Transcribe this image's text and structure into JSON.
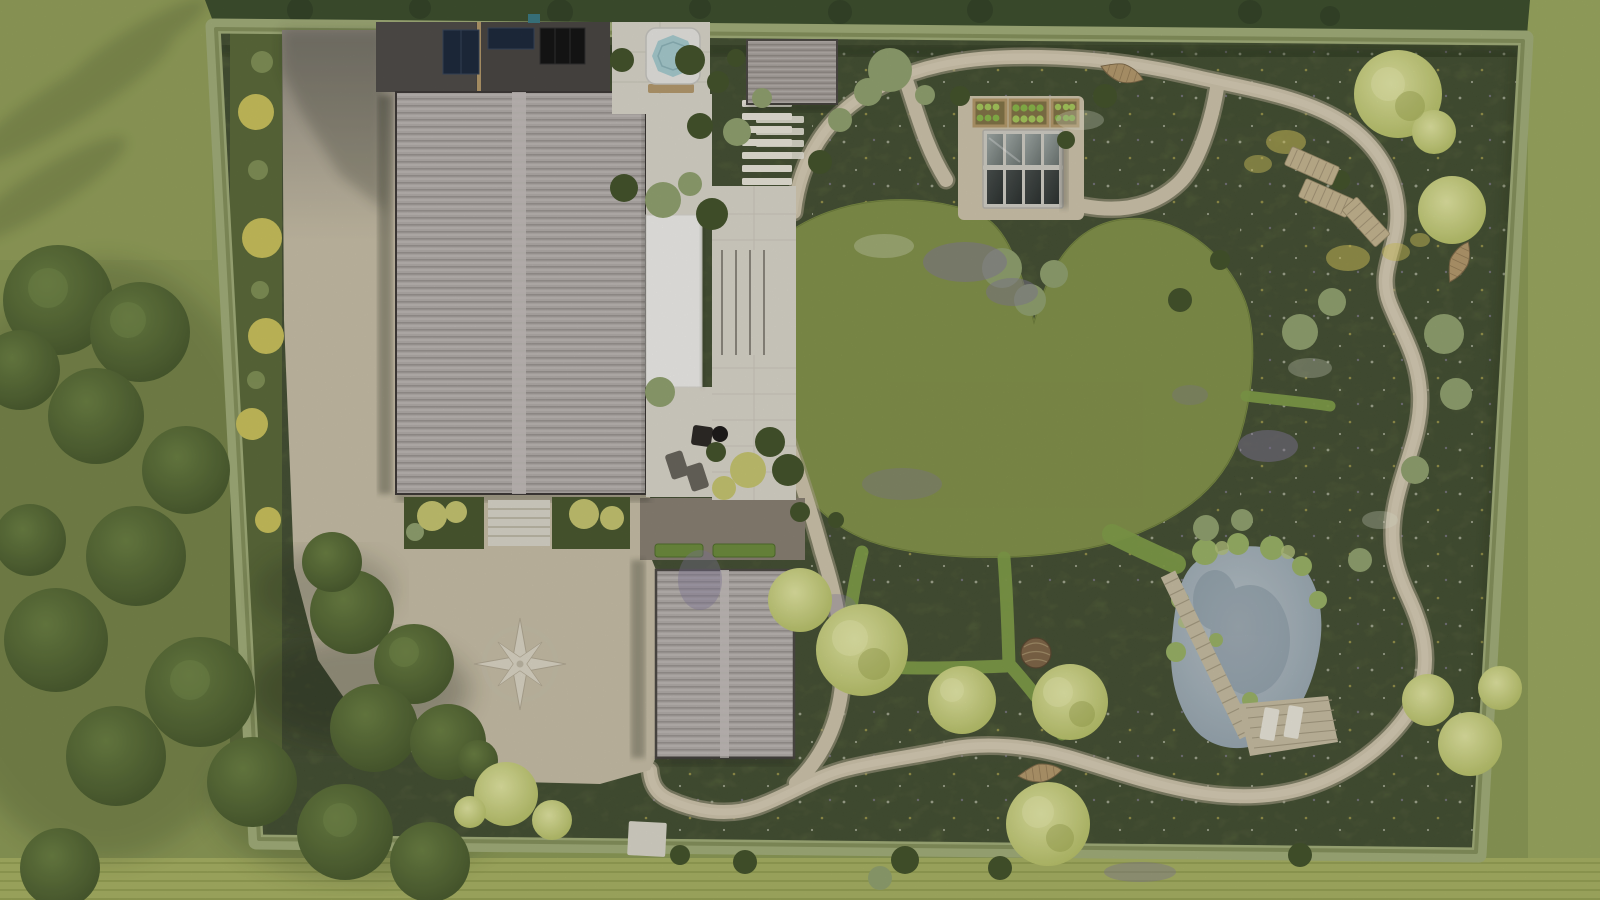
{
  "scene": {
    "type": "aerial-garden-landscape-plan",
    "view": "top-down-render",
    "features": [
      "main-house",
      "flat-roof-annex",
      "solar-panels",
      "hot-tub",
      "garden-shed",
      "garage",
      "patio-terrace",
      "awning",
      "terrace-steps",
      "stepping-stone-slats",
      "fire-pit-seating",
      "driveway",
      "compass-paving-ornament",
      "entrance-steps",
      "front-planting-beds",
      "perimeter-hedge",
      "boundary-trees",
      "wildflower-meadow",
      "central-lawn",
      "gravel-path-loop",
      "mown-grass-paths",
      "greenhouse",
      "raised-vegetable-beds",
      "natural-pond",
      "boardwalk-jetty",
      "pond-deck",
      "deck-loungers",
      "meadow-sun-loungers",
      "leaf-benches",
      "wicker-sculpture",
      "clipped-hedges",
      "stone-pads"
    ]
  },
  "palette": {
    "outside_lawn": "#8f9d59",
    "outside_lawn_light": "#9dab62",
    "outside_strip_bottom": "#a9b365",
    "tree_band": "#3f5130",
    "tree_dark_hi": "#6c8144",
    "tree_dark_lo": "#48592e",
    "tree_lime_hi": "#e3e7a3",
    "tree_lime_lo": "#b5bf65",
    "hedge": "#a4b07b",
    "hedge_dark": "#6b7844",
    "meadow": "#506035",
    "meadow_strip": "#5d6c3c",
    "lawn": "#98a958",
    "mown": "#83a04b",
    "gravel": "#d0c6ae",
    "gravel_edge": "#b4aa92",
    "gravel_light": "#dbd2bb",
    "driveway": "#cac1a9",
    "driveway_shadow_top": "#938d83",
    "courtyard": "#8b8275",
    "roof_base": "#b5afac",
    "roof_line": "#9c9693",
    "roof_light": "#c5c0bd",
    "flat_roof": "#4b4845",
    "solar": "#1f2b3e",
    "solar_dark": "#161616",
    "skylight": "#3d7b86",
    "paver": "#dcd8cc",
    "awning": "#f1f0ec",
    "white_slat": "#ebe8dc",
    "hot_tub_shell": "#e9e8e4",
    "hot_tub_water": "#a9ced2",
    "wood": "#b79c6f",
    "deck": "#c9bfa4",
    "pond_hi": "#bcc6cc",
    "pond_lo": "#96a6b0",
    "greenhouse_frame": "#d3d0c8",
    "glass_top_hi": "#a3aca9",
    "glass_top_lo": "#6f7875",
    "glass_bot_hi": "#4b514f",
    "glass_bot_lo": "#2e3432",
    "bed_frame": "#b69b6c",
    "soil": "#857649",
    "lettuce_a": "#a9cb5f",
    "lettuce_b": "#8cb94c",
    "wicker": "#82694a",
    "compass": "#ded8c8",
    "bloom_purple": "#857a9e",
    "bloom_white": "#e9ead8",
    "bloom_yellow": "#d6c75f",
    "sage": "#93a471",
    "bush_dark": "#46552d",
    "yellow_shrub": "#cdc45e"
  }
}
